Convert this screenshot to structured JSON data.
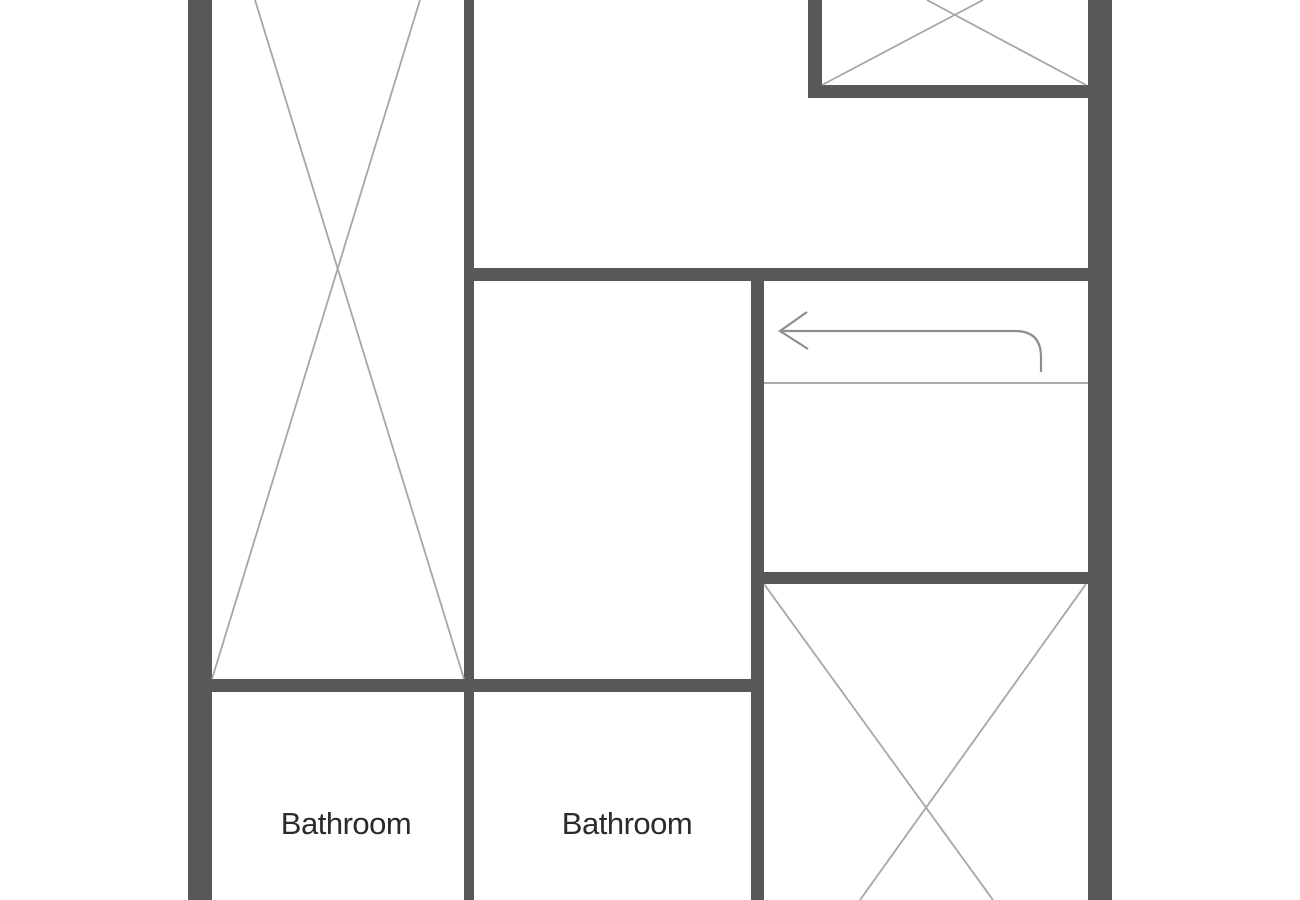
{
  "canvas": {
    "width": 1300,
    "height": 900,
    "background": "#ffffff"
  },
  "colors": {
    "wall": "#58585A",
    "fixture_line": "#A6A6A6",
    "stair_line": "#919191",
    "arrow": "#8E8E8E",
    "label_text": "#2B2B2B"
  },
  "floorplan": {
    "walls": [
      {
        "name": "outer-wall-left",
        "x": 188,
        "y": 0,
        "w": 24,
        "h": 900
      },
      {
        "name": "outer-wall-right",
        "x": 1088,
        "y": 0,
        "w": 24,
        "h": 900
      },
      {
        "name": "center-vertical-wall",
        "x": 464,
        "y": 0,
        "w": 10,
        "h": 900
      },
      {
        "name": "stairwell-left-wall",
        "x": 751,
        "y": 268,
        "w": 13,
        "h": 632
      },
      {
        "name": "top-right-room-left-wall",
        "x": 808,
        "y": 0,
        "w": 14,
        "h": 98
      },
      {
        "name": "top-right-room-bottom-wall",
        "x": 808,
        "y": 85,
        "w": 280,
        "h": 13
      },
      {
        "name": "upper-horizontal-wall",
        "x": 464,
        "y": 268,
        "w": 624,
        "h": 13
      },
      {
        "name": "lower-right-horizontal-wall",
        "x": 751,
        "y": 572,
        "w": 337,
        "h": 12
      },
      {
        "name": "lower-left-horizontal-wall",
        "x": 188,
        "y": 679,
        "w": 576,
        "h": 13
      }
    ],
    "fixture_lines": [
      {
        "name": "closet-left-x-line-1",
        "x1": 255,
        "y1": 0,
        "x2": 464,
        "y2": 679
      },
      {
        "name": "closet-left-x-line-2",
        "x1": 420,
        "y1": 0,
        "x2": 212,
        "y2": 679
      },
      {
        "name": "closet-top-right-x-line-1",
        "x1": 983,
        "y1": 0,
        "x2": 822,
        "y2": 85
      },
      {
        "name": "closet-top-right-x-line-2",
        "x1": 927,
        "y1": 0,
        "x2": 1086,
        "y2": 85
      },
      {
        "name": "room-bottom-right-x-line-1",
        "x1": 764,
        "y1": 584,
        "x2": 993,
        "y2": 900
      },
      {
        "name": "room-bottom-right-x-line-2",
        "x1": 1086,
        "y1": 584,
        "x2": 860,
        "y2": 900
      }
    ],
    "stair_lines": [
      {
        "name": "stair-tread-line",
        "x1": 764,
        "y1": 383,
        "x2": 1088,
        "y2": 383
      }
    ],
    "arrow": {
      "name": "stair-direction-arrow",
      "head_path": "M 807 312 L 780 331 L 808 349",
      "shaft_path": "M 780 331 L 1015 331 Q 1041 331 1041 357 L 1041 372"
    },
    "labels": [
      {
        "name": "room-label-bathroom-1",
        "text": "Bathroom",
        "x": 346,
        "y": 834
      },
      {
        "name": "room-label-bathroom-2",
        "text": "Bathroom",
        "x": 627,
        "y": 834
      }
    ]
  }
}
